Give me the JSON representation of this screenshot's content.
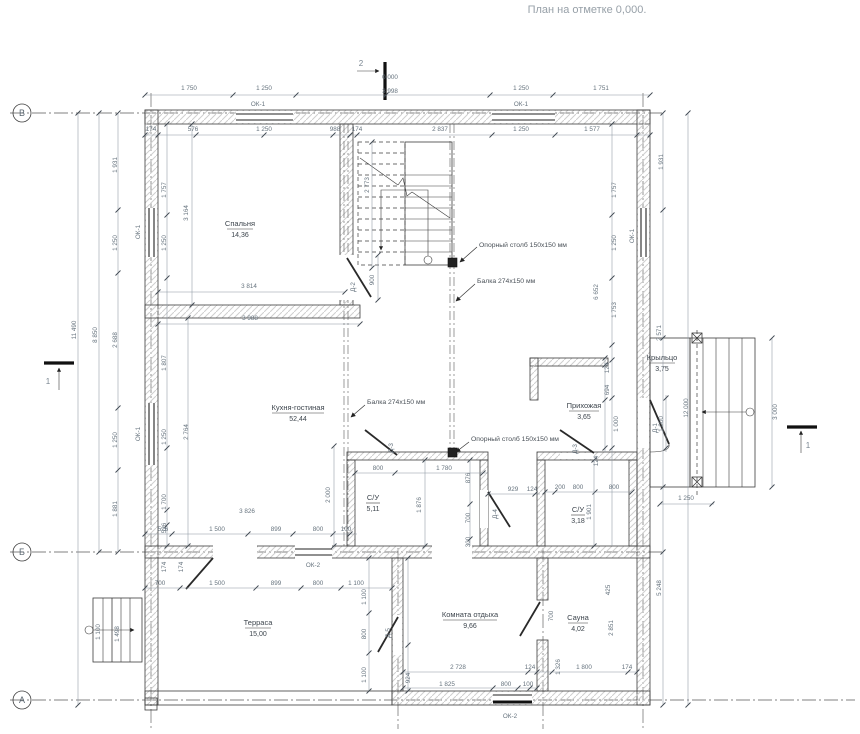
{
  "title": "План на отметке 0,000.",
  "elevation_mark": "0.000",
  "axis_bubbles": {
    "v": "В",
    "b": "Б",
    "a": "А"
  },
  "section_markers": {
    "s1": "1",
    "s2": "2"
  },
  "rooms": [
    {
      "name": "Спальня",
      "area": "14,36"
    },
    {
      "name": "Кухня-гостиная",
      "area": "52,44"
    },
    {
      "name": "С/У",
      "area": "5,11"
    },
    {
      "name": "С/У",
      "area": "3,18"
    },
    {
      "name": "Прихожая",
      "area": "3,65"
    },
    {
      "name": "Крыльцо",
      "area": "3,75"
    },
    {
      "name": "Терраса",
      "area": "15,00"
    },
    {
      "name": "Комната отдыха",
      "area": "9,66"
    },
    {
      "name": "Сауна",
      "area": "4,02"
    }
  ],
  "annotations": {
    "post": "Опорный столб 150х150 мм",
    "beam": "Балка 274х150 мм"
  },
  "windows": {
    "ok1": "ОК-1",
    "ok2": "ОК-2"
  },
  "doors": {
    "d1": "Д-1",
    "d2": "Д-2",
    "d3": "Д-3",
    "d4": "Д-4",
    "d5": "Д-5"
  },
  "dims": {
    "top1": [
      "1 750",
      "1 250",
      "3 998",
      "1 250",
      "1 751"
    ],
    "top2": [
      "174",
      "576",
      "1 250",
      "988",
      "174",
      "2 837",
      "1 250",
      "1 577"
    ],
    "left_total": "11 490",
    "left_vb": "8 850",
    "left_outer": [
      "1 931",
      "1 250",
      "2 688",
      "1 250",
      "1 881"
    ],
    "left_inner": [
      "1 757",
      "1 250",
      "1 807",
      "1 250",
      "1 700",
      "526"
    ],
    "right_inner": [
      "1 757",
      "1 250",
      "1 753",
      "6 652",
      "124",
      "694",
      "1 000",
      "425",
      "2 851"
    ],
    "right_outer": [
      "1 931",
      "2 571",
      "1 000",
      "12 000",
      "5 248",
      "3 000",
      "1 250"
    ],
    "bedroom": [
      "3 164",
      "3 814",
      "3 988"
    ],
    "stair": [
      "2 773",
      "900"
    ],
    "kitchen": [
      "2 764",
      "2 000",
      "3 826",
      "526",
      "1 500",
      "899",
      "800",
      "100",
      "174",
      "174"
    ],
    "bath1": [
      "800",
      "1 780",
      "1 876",
      "876",
      "700",
      "300"
    ],
    "bath2": [
      "929",
      "124",
      "200",
      "800",
      "800",
      "1 901",
      "124"
    ],
    "terrace": [
      "700",
      "1 500",
      "899",
      "800",
      "1 100",
      "1 100",
      "800",
      "1 100",
      "924",
      "1 100",
      "1 498"
    ],
    "rest": [
      "2 728",
      "124",
      "1 825",
      "800",
      "100",
      "700"
    ],
    "sauna": [
      "1 326",
      "1 800",
      "174"
    ]
  }
}
